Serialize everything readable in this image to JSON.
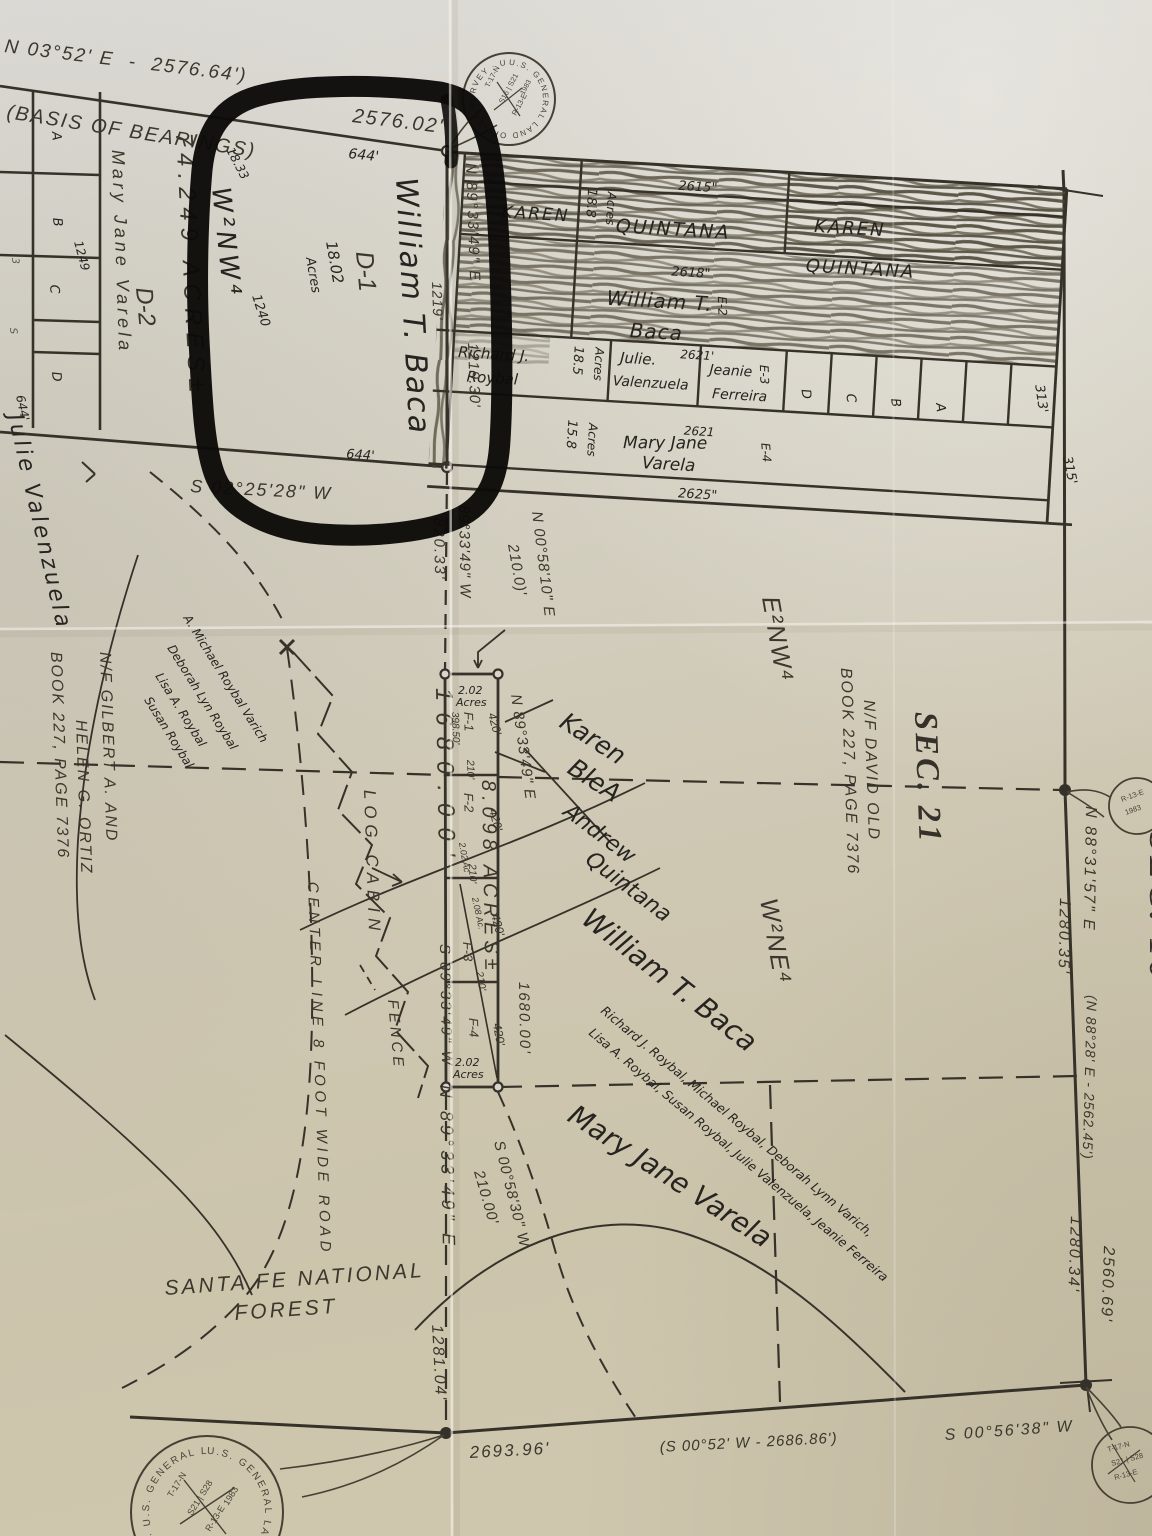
{
  "top": {
    "ref_bearing": "N 03°52' E  -  2576.64')",
    "basis": "(BASIS OF BEARINGS)",
    "dist": "2576.02'",
    "dist_hw": "644'"
  },
  "left_grid": {
    "cells": [
      "A",
      "B",
      "C",
      "D"
    ],
    "marks": [
      "3",
      "S"
    ],
    "hw_1249": "1249",
    "hw_644": "644'",
    "owner": "Mary Jane Varela",
    "lot": "D-2",
    "area": "74.249 ACRES±",
    "aliquot_hw": "W²NW⁴",
    "hw_1833": "18.33"
  },
  "parcel_d1": {
    "owner_hw": "William T. Baca",
    "lot": "D-1",
    "area_hw_1": "18.02",
    "area_hw_2": "Acres",
    "hw_1240": "1240",
    "hw_1219": "1219'",
    "east_bearing": "N 89°33'49\" E",
    "east_dist": "1219.30'",
    "south_bearing": "S 02°25'28\" W",
    "south_hw": "644'"
  },
  "block": {
    "r1_left": "KAREN",
    "r1_mid": "QUINTANA",
    "r1_hw": "2615\"",
    "r1_right_1": "KAREN",
    "r1_right_2": "QUINTANA",
    "r1_area_1": "18.8",
    "r1_area_2": "Acres",
    "r2_hw": "2618\"",
    "r2_name_1": "William T.",
    "r2_name_2": "Baca",
    "r2_tag": "E-2",
    "r3_c1_1": "Richard J.",
    "r3_c1_2": "Roybal",
    "r3_area_1": "18.5",
    "r3_area_2": "Acres",
    "r3_c2_1": "Julie.",
    "r3_c2_2": "Valenzuela",
    "r3_hw": "2621'",
    "r3_c3_1": "Jeanie",
    "r3_c3_2": "Ferreira",
    "r3_tag": "E-3",
    "r3_small": [
      "D",
      "C",
      "B",
      "A"
    ],
    "r3_hw_313": "313'",
    "r4_area_1": "15.8",
    "r4_area_2": "Acres",
    "r4_hw": "2621",
    "r4_name_1": "Mary Jane",
    "r4_name_2": "Varela",
    "r4_tag": "E-4",
    "r4_hw_2625": "2625\"",
    "hw_315": "315'"
  },
  "center": {
    "q_bear": "89°33'49\" W",
    "q_dist": "820.33'",
    "n0058_b": "N 00°58'10\" E",
    "n0058_d": "210.0)'",
    "strip": {
      "west_dist": "1680.00'",
      "east_dist": "1680.00'",
      "area_big": "8.098 ACRES±",
      "f1": "F-1",
      "f1_area_1": "2.02",
      "f1_area_2": "Acres",
      "f1_dist": "398.50'",
      "f1_w": "420'",
      "t210_1": "210'",
      "f2": "F-2",
      "f2_w": "420'",
      "f2_area": "2.02 Ac",
      "t210_2": "210'",
      "f3": "F-3",
      "f3_w": "420'",
      "f3_area": "2.08 Ac.",
      "t210_3": "210'",
      "f4": "F-4",
      "f4_w": "420'",
      "f4_area_1": "2.02",
      "f4_area_2": "Acres"
    },
    "ne_bear": "N 89°33'49\" E",
    "sw_bear": "S 89°33'49\" W",
    "ne_bear2": "N 89°33'49\" E",
    "s0058_b": "S 00°58'30\" W",
    "s0058_d": "210.00'",
    "log_cabin": "LOG CABIN",
    "fence": "FENCE",
    "road": "CENTER LINE 8 FOOT WIDE ROAD",
    "forest_1": "SANTA FE NATIONAL",
    "forest_2": "FOREST",
    "sec21": "SEC. 21",
    "nf_david_1": "N/F DAVID OLD",
    "nf_david_2": "BOOK 227, PAGE 7376",
    "e2nw4": "E²NW⁴",
    "w2ne4": "W²NE⁴",
    "nf_gilbert_1": "N/F GILBERT A. AND",
    "nf_gilbert_2": "HELEN G. ORTIZ",
    "nf_gilbert_3": "BOOK 227, PAGE 7376",
    "julie_hw": "Julie Valenzuela",
    "roybal_hw": [
      "A. Michael Roybal Varich",
      "Deborah Lyn Roybal",
      "Lisa A. Roybal",
      "Susan Roybal"
    ],
    "list_hw_1": "Richard J. Roybal, Michael Roybal, Deborah Lynn Varich,",
    "list_hw_2": "Lisa A. Roybal, Susan Roybal, Julie Valenzuela, Jeanie Ferreira",
    "karen_hw_1": "Karen",
    "karen_hw_2": "BleA",
    "andrew_hw_1": "Andrew",
    "andrew_hw_2": "Quintana",
    "william_hw": "William T. Baca",
    "mary_hw": "Mary Jane Varela"
  },
  "east": {
    "bear": "N 88°31'57\" E",
    "d1": "1280.35'",
    "ref": "(N 88°28' E - 2562.45')",
    "d2": "1280.34'",
    "d3": "2560.69'",
    "sec16": "SEC. 16"
  },
  "south": {
    "d1": "2693.96'",
    "ref": "(S 00°52' W - 2686.86')",
    "bear": "S 00°56'38\" W",
    "d2": "1281.04'"
  },
  "seals": {
    "ring": "U.S. GENERAL LAND OFFICE SURVEY · U.S. GENERAL LAND OFFICE SURVEY",
    "top_l1": "T-17-N",
    "top_l2": "S16 | S21",
    "top_l3": "R-13-E",
    "top_l4": "1983",
    "small_l1": "R-13-E",
    "small_l2": "1983",
    "bottom_l1": "T-17-N",
    "bottom_l2": "S21 | S28",
    "bottom_l3": "R-13-E",
    "bottom_l4": "1983"
  }
}
